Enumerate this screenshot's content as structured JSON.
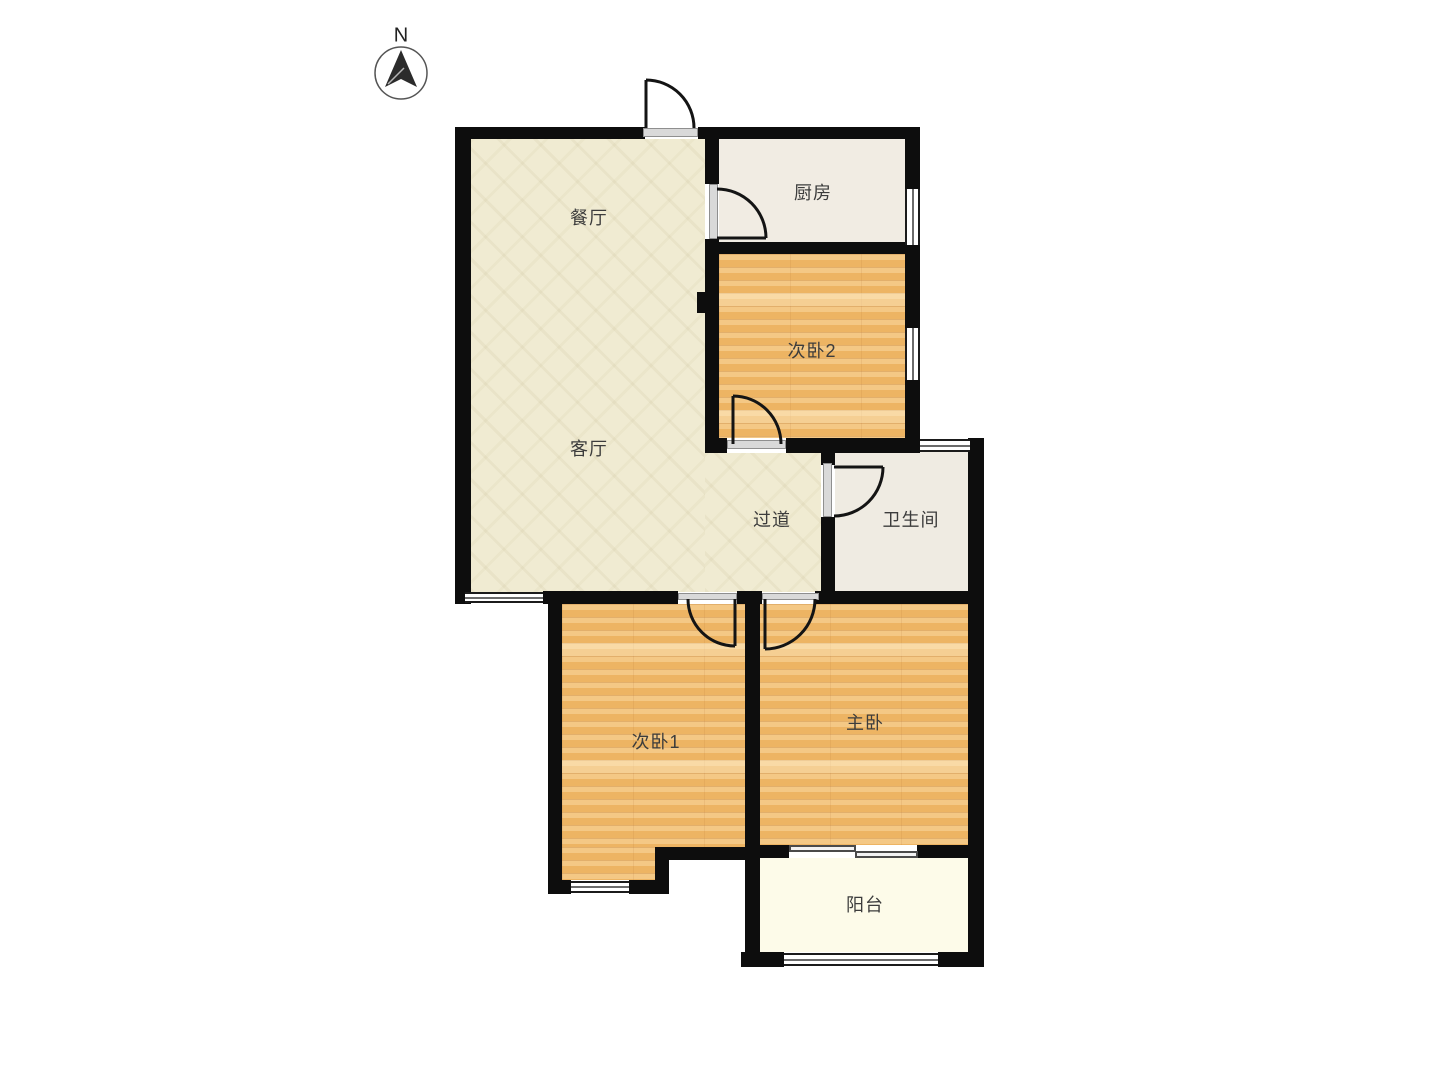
{
  "compass": {
    "label": "N"
  },
  "rooms": [
    {
      "id": "dining",
      "label": "餐厅"
    },
    {
      "id": "kitchen",
      "label": "厨房"
    },
    {
      "id": "bedroom2",
      "label": "次卧2"
    },
    {
      "id": "living",
      "label": "客厅"
    },
    {
      "id": "hallway",
      "label": "过道"
    },
    {
      "id": "bathroom",
      "label": "卫生间"
    },
    {
      "id": "bedroom1",
      "label": "次卧1"
    },
    {
      "id": "master",
      "label": "主卧"
    },
    {
      "id": "balcony",
      "label": "阳台"
    }
  ],
  "colors": {
    "canvas": "#ffffff",
    "wall": "#0d0d0d",
    "floor-beige": "#f0ebd2",
    "floor-wood": "#eeb566",
    "floor-kitchen": "#f1ece3",
    "floor-bath": "#efebe2",
    "floor-balcony": "#fdfbe9",
    "label": "#3c3c3c"
  }
}
